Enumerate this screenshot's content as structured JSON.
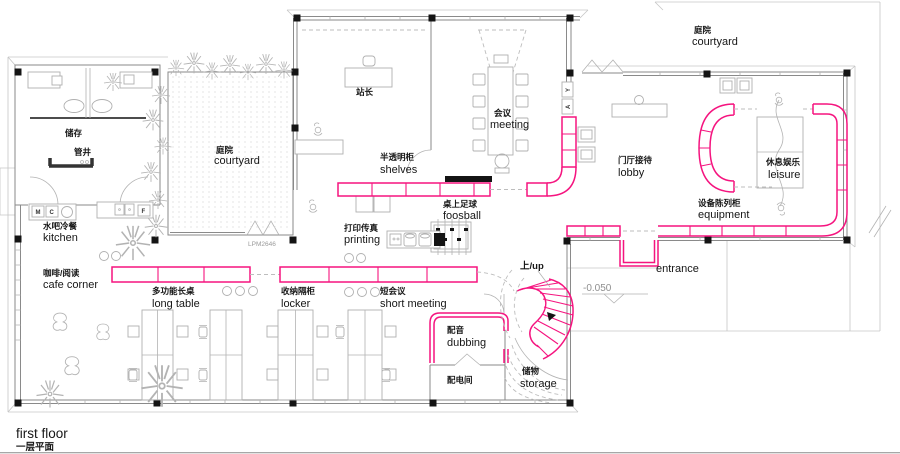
{
  "colors": {
    "accent_pink": "#f5147f",
    "line_grey": "#8a8a8a",
    "ink": "#141414"
  },
  "plan": {
    "title_en": "first floor",
    "title_zh": "一层平面",
    "level_mark": "-0.050",
    "window_code": "LPM2646"
  },
  "rooms": {
    "store": {
      "zh": "储存"
    },
    "shaft": {
      "zh": "管井"
    },
    "courtyard_left": {
      "zh": "庭院",
      "en": "courtyard"
    },
    "courtyard_right": {
      "zh": "庭院",
      "en": "courtyard"
    },
    "station_master": {
      "zh": "站长"
    },
    "meeting": {
      "zh": "会议",
      "en": "meeting"
    },
    "shelves": {
      "zh": "半透明柜",
      "en": "shelves"
    },
    "lobby": {
      "zh": "门厅接待",
      "en": "lobby"
    },
    "leisure": {
      "zh": "休息娱乐",
      "en": "leisure"
    },
    "equipment": {
      "zh": "设备陈列柜",
      "en": "equipment"
    },
    "foosball": {
      "zh": "桌上足球",
      "en": "foosball"
    },
    "printing": {
      "zh": "打印传真",
      "en": "printing"
    },
    "kitchen": {
      "zh": "水吧冷餐",
      "en": "kitchen"
    },
    "cafe_corner": {
      "zh": "咖啡/阅读",
      "en": "cafe corner"
    },
    "long_table": {
      "zh": "多功能长桌",
      "en": "long table"
    },
    "locker": {
      "zh": "收纳隔柜",
      "en": "locker"
    },
    "short_meeting": {
      "zh": "短会议",
      "en": "short meeting"
    },
    "stair_up": {
      "zh": "上/up"
    },
    "dubbing": {
      "zh": "配音",
      "en": "dubbing"
    },
    "electrical": {
      "zh": "配电间"
    },
    "storage_understair": {
      "zh": "储物",
      "en": "storage"
    },
    "entrance": {
      "en": "entrance"
    }
  },
  "fixtures": {
    "m": "M",
    "c": "C",
    "f": "F",
    "y": "Y",
    "a": "A"
  }
}
